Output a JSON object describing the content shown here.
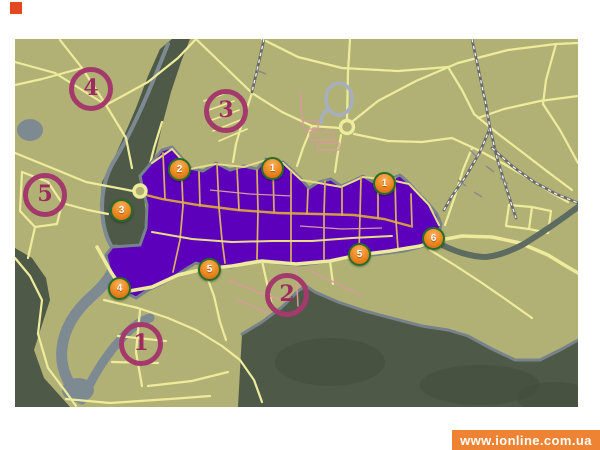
{
  "watermark": {
    "text": "www.ionline.com.ua"
  },
  "colors": {
    "page_bg": "#ffffff",
    "logo_red": "#e2491f",
    "banner_bg": "#ee8433",
    "banner_fg": "#ffffff",
    "olive": "#b2b175",
    "road": "#eeec9c",
    "pink": "#d89a9a",
    "purple": "#5c00bb",
    "proad_orange": "#d59a44",
    "proad_yellow": "#d9b05e",
    "proad_pale": "#e6dc8a",
    "forest": "#4e5947",
    "forest2": "#414c3b",
    "river": "#7e8a92",
    "shore": "#78828a",
    "eriver": "#5d6b60",
    "rail": "#6a6a6a",
    "stadium": "#a6afc0",
    "marker_ring": "#256d2a",
    "ring_color": "#a33a6b",
    "ring_digit": "#9c2c5e"
  },
  "map": {
    "orange_markers": [
      {
        "label": "2",
        "x": 180,
        "y": 170
      },
      {
        "label": "1",
        "x": 273,
        "y": 169
      },
      {
        "label": "1",
        "x": 385,
        "y": 184
      },
      {
        "label": "3",
        "x": 122,
        "y": 211
      },
      {
        "label": "4",
        "x": 120,
        "y": 289
      },
      {
        "label": "5",
        "x": 210,
        "y": 270
      },
      {
        "label": "5",
        "x": 360,
        "y": 255
      },
      {
        "label": "6",
        "x": 434,
        "y": 239
      }
    ],
    "ring_markers": [
      {
        "label": "4",
        "x": 91,
        "y": 89
      },
      {
        "label": "3",
        "x": 226,
        "y": 111
      },
      {
        "label": "5",
        "x": 45,
        "y": 195
      },
      {
        "label": "1",
        "x": 141,
        "y": 344
      },
      {
        "label": "2",
        "x": 287,
        "y": 295
      }
    ]
  }
}
